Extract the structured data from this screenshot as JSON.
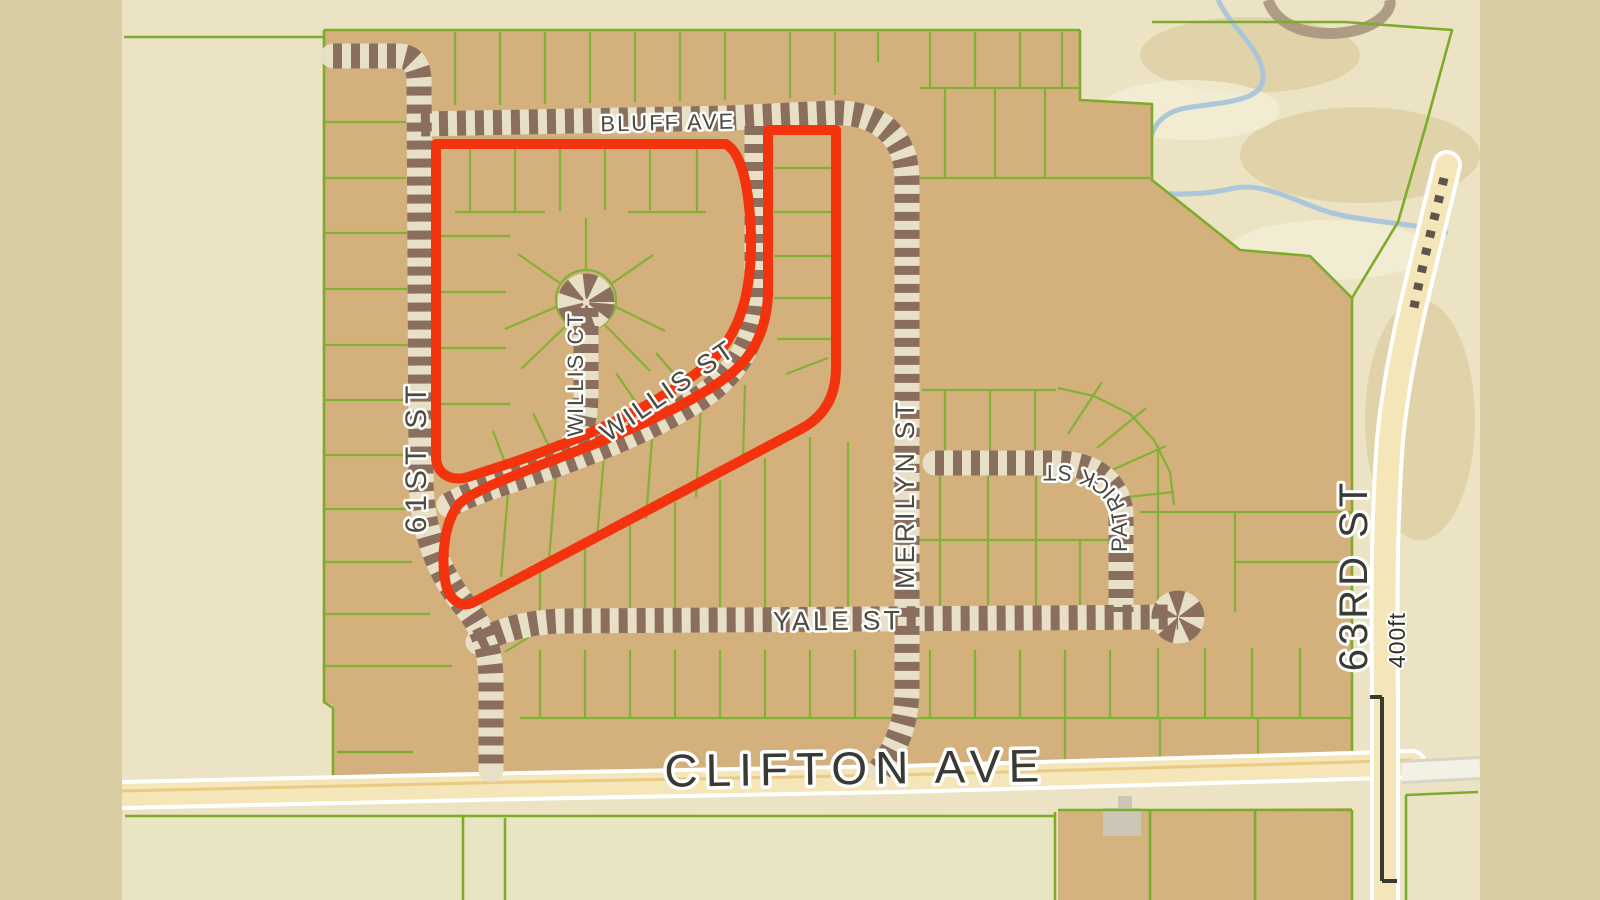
{
  "map": {
    "streets": {
      "bluff_ave": "BLUFF AVE",
      "willis_ct": "WILLIS CT",
      "willis_st": "WILLIS ST",
      "sixty_first": "61ST ST",
      "merilyn": "MERILYN ST",
      "patrick": "PATRICK ST",
      "yale": "YALE ST",
      "clifton": "CLIFTON AVE",
      "sixty_third": "63RD ST"
    },
    "scale": {
      "label": "400ft"
    },
    "colors": {
      "background_khaki": "#d9cda4",
      "terrain_cream": "#ebe3c3",
      "parcel_tan": "#d3b07c",
      "parcel_pale": "#e9e4c2",
      "lot_line_green": "#82b136",
      "rail_dark": "#8a6f5f",
      "rail_light": "#e7dfc6",
      "road_fill": "#f4e6b8",
      "road_casing": "#ffffff",
      "highlight_red": "#f2330e",
      "stream_blue": "#a9c5da",
      "label_gray": "#4b4b41",
      "building_gray": "#ccc6b6"
    },
    "geometry": {
      "tan_block": "M324,30 L1080,30 L1080,100 L1152,104 L1152,180 L1240,250 L1310,256 L1352,298 L1352,762 L920,772 L520,782 L333,782 L333,705 L324,702 Z",
      "pale_below_clifton": "M125,816 L1055,812 L1055,900 L125,900 Z",
      "tan_below_clifton": "M1058,810 L1352,808 L1352,900 L1058,900 Z",
      "building_main": "M1103,808 H1141 V836 H1103 Z",
      "building_small": "M1118,796 H1132 V810 H1118 Z",
      "boundaries": [
        "M324,30 H1080",
        "M324,30 L324,702 L333,708 L333,782",
        "M1080,30 V100 L1152,104 V180 L1240,250 L1310,256 L1352,298 V762",
        "M1152,22 H1345 L1452,30 L1426,125 L1398,222 L1352,298",
        "M124,37 H324",
        "M126,783 L333,780",
        "M337,752 H413",
        "M125,816 H463 V900",
        "M463,816 H1055",
        "M505,818 V900",
        "M1055,812 V900",
        "M1058,810 H1352",
        "M1150,810 V900",
        "M1255,810 V900",
        "M1352,810 V900",
        "M1406,795 V900",
        "M1406,795 L1478,792"
      ],
      "lots": [
        "M324,66 H404",
        "M324,122 H406",
        "M324,178 H406",
        "M324,233 H407",
        "M324,289 H407",
        "M324,345 H408",
        "M324,400 H408",
        "M324,455 H409",
        "M324,509 H410",
        "M324,562 H412",
        "M324,614 H430",
        "M324,666 H452",
        "M455,32 V105",
        "M500,32 V105",
        "M545,32 V104",
        "M590,32 V103",
        "M635,32 V102",
        "M680,32 V101",
        "M725,32 V100",
        "M790,32 V98",
        "M835,32 V95",
        "M878,32 V62",
        "M930,32 V88",
        "M975,32 V88",
        "M1020,32 V88",
        "M1062,32 V88",
        "M920,88 H1080",
        "M945,88 V178",
        "M995,88 V178",
        "M1045,88 V178",
        "M920,178 H1150",
        "M470,146 V212",
        "M515,146 V212",
        "M560,146 V211",
        "M605,146 V210",
        "M650,145 V210",
        "M697,145 V212",
        "M455,212 H545",
        "M628,212 H706",
        "M440,236 H510",
        "M440,292 H506",
        "M440,348 H506",
        "M440,404 H510",
        "M616,300 a30,30 0 1,0 -60,0 a30,30 0 1,0 60,0",
        "M586,270 V218",
        "M561,284 L518,254",
        "M611,284 L653,255",
        "M556,307 L505,329",
        "M616,307 L665,331",
        "M567,325 L521,369",
        "M605,325 L650,371",
        "M690,392 L656,353",
        "M646,417 L616,373",
        "M599,439 L573,397",
        "M554,457 L533,413",
        "M509,473 L493,431",
        "M774,168 H832",
        "M774,212 H832",
        "M774,256 H832",
        "M774,298 H832",
        "M777,339 H831",
        "M786,374 L828,358",
        "M509,481 L501,577",
        "M557,463 L549,559",
        "M605,444 L597,539",
        "M653,426 L646,519",
        "M701,407 L696,497",
        "M745,385 L743,461",
        "M540,569 V612",
        "M585,547 V612",
        "M630,525 V612",
        "M675,502 V612",
        "M720,480 V612",
        "M765,458 V612",
        "M810,437 V612",
        "M848,442 V612",
        "M940,468 V540",
        "M988,468 V540",
        "M1036,468 V540",
        "M912,540 H1116",
        "M940,540 V612",
        "M988,540 V612",
        "M1036,540 V612",
        "M1080,540 V612",
        "M945,390 V456",
        "M990,390 V456",
        "M1035,390 V456",
        "M922,390 H1056",
        "M1068,434 L1102,382",
        "M1097,448 L1146,408",
        "M1112,470 L1166,446",
        "M1118,498 L1174,492",
        "M1058,388 L1094,396 L1130,414 L1154,440 L1170,472 L1174,505",
        "M1158,445 V612",
        "M1140,512 H1352",
        "M1235,512 V612",
        "M1235,562 H1352",
        "M540,650 V718",
        "M585,650 V718",
        "M630,650 V718",
        "M675,650 V718",
        "M720,650 V718",
        "M765,650 V718",
        "M810,650 V718",
        "M855,650 V718",
        "M930,650 V718",
        "M975,650 V718",
        "M1020,650 V718",
        "M1065,650 V718",
        "M1110,650 V718",
        "M1158,648 V718",
        "M1205,648 V718",
        "M1252,648 V718",
        "M1300,648 V718",
        "M520,718 H1352",
        "M1065,718 V760",
        "M1160,718 V758",
        "M1258,718 V756",
        "M505,652 L540,630"
      ],
      "railroads": [
        "M333,56 H398 C412,56 418,64 419,78 L421,478 C421,532 441,577 466,607 C484,629 491,652 491,682 L491,770",
        "M421,124 L728,118 L832,113 C874,111 906,132 907,178 L907,688 C907,720 898,746 880,770",
        "M757,126 V295 C757,336 741,366 711,390 C666,425 584,456 504,483 C481,490 462,498 449,505",
        "M586,308 V395 C586,420 580,436 569,449",
        "M935,463 H1055 C1093,463 1118,481 1121,513 V612",
        "M478,642 C505,628 532,622 562,621 L1178,617",
        "M602,302 a16,16 0 1,0 -32,0 a16,16 0 1,0 32,0",
        "M1192,617 a14,14 0 1,0 -28,0 a14,14 0 1,0 28,0"
      ],
      "red_loops": [
        "M436,144 L726,144 C742,154 749,186 751,234 C752,286 743,326 716,356 C676,396 596,434 514,462 L468,477 C451,482 437,474 436,458 Z",
        "M772,130 L836,130 L836,368 C836,398 823,418 799,430 L474,602 C461,609 450,600 446,585 C440,556 445,521 459,504 C472,491 520,473 569,454 C639,427 699,400 733,372 C756,352 766,327 768,296 L768,130 Z"
      ],
      "clifton_main": "M122,795 L520,786 L900,779 L1352,766 L1412,764",
      "clifton_east": "M1402,772 L1480,768",
      "road63": "M1447,165 C1425,260 1398,352 1390,440 C1384,520 1384,600 1385,700 L1385,900",
      "rail63": "M1444,178 C1432,228 1420,274 1412,318",
      "loop_tr": "M1268,0 C1276,24 1304,36 1340,33 C1372,30 1392,14 1390,0",
      "stream": "M1218,0 C1232,30 1266,52 1263,80 C1260,102 1222,102 1186,108 C1158,113 1147,132 1150,158 C1152,178 1136,186 1116,189 C1146,193 1190,198 1230,189 C1268,180 1300,206 1340,215 C1378,223 1420,224 1448,233",
      "patrick_label_path": "M1127,592 L1127,520 C1125,487 1098,467 1058,465 L942,465",
      "scalebar": "M1370,697 H1382 M1382,697 V881 M1382,881 H1397"
    }
  }
}
